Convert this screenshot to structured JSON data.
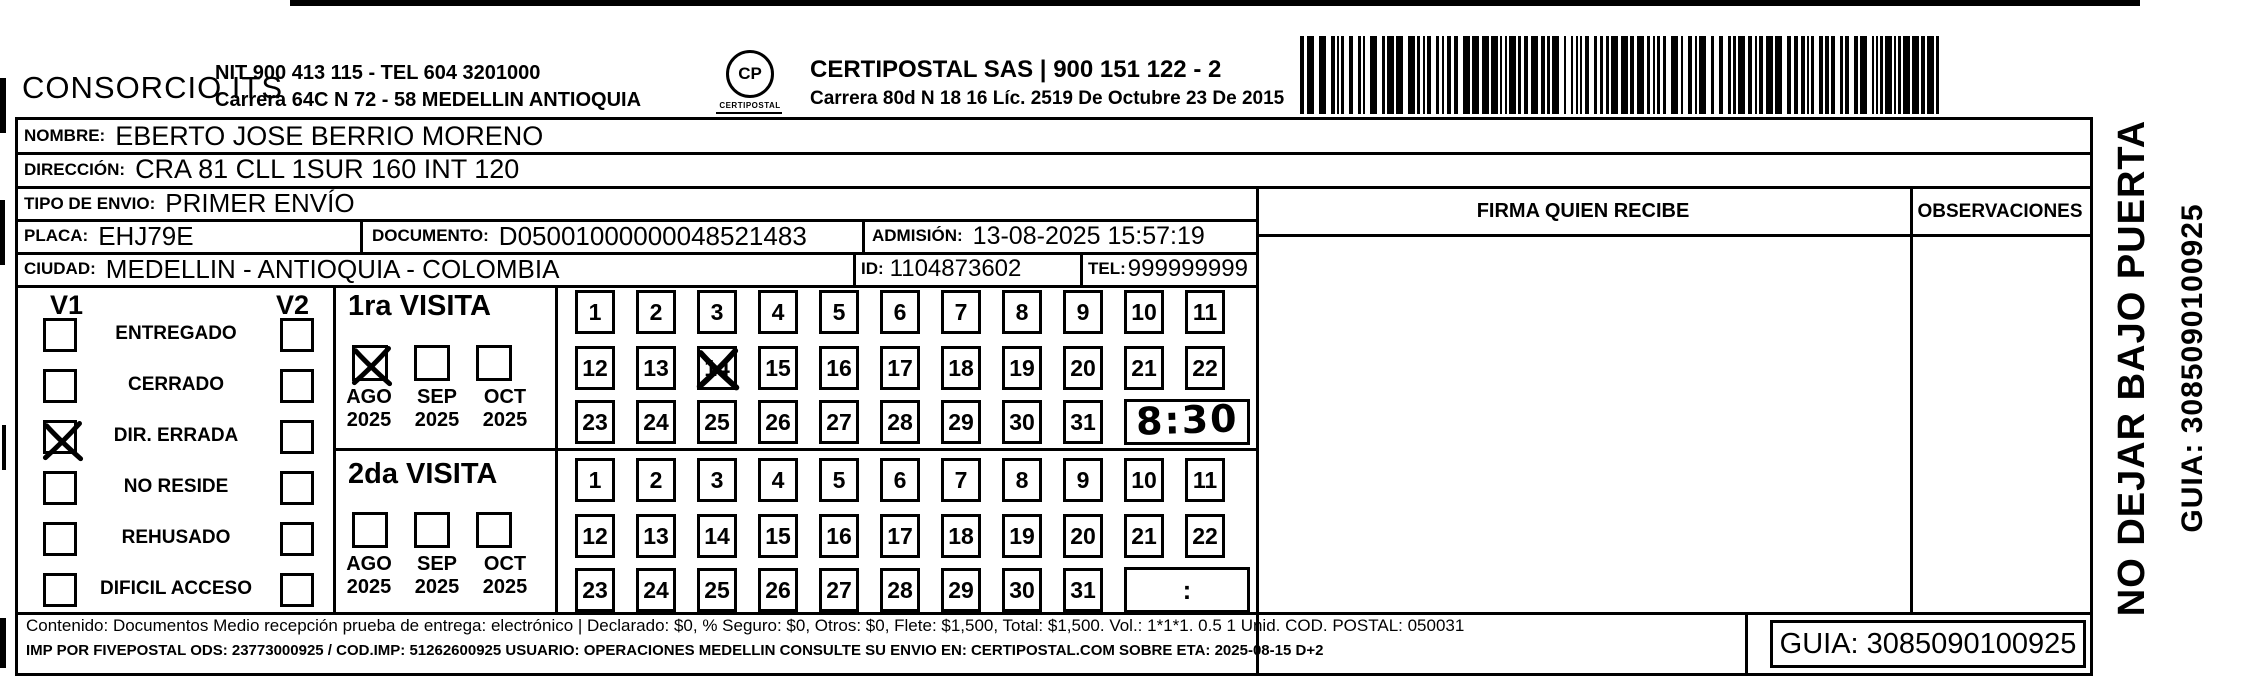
{
  "header": {
    "consorcio": "CONSORCIO ITS",
    "nit_line1": "NIT 900 413 115 - TEL 604 3201000",
    "nit_line2": "Carrera 64C N 72 - 58 MEDELLIN ANTIOQUIA",
    "logo_mark": "CP",
    "logo_text": "CERTIPOSTAL",
    "certipostal_line1": "CERTIPOSTAL SAS | 900 151 122 - 2",
    "certipostal_line2": "Carrera 80d N 18 16  Líc. 2519 De Octubre 23 De 2015"
  },
  "fields": {
    "nombre_label": "NOMBRE:",
    "nombre": "EBERTO JOSE BERRIO MORENO",
    "direccion_label": "DIRECCIÓN:",
    "direccion": "CRA 81 CLL 1SUR 160 INT 120",
    "tipo_envio_label": "TIPO DE ENVIO:",
    "tipo_envio": "PRIMER ENVÍO",
    "placa_label": "PLACA:",
    "placa": "EHJ79E",
    "documento_label": "DOCUMENTO:",
    "documento": "D05001000000048521483",
    "admision_label": "ADMISIÓN:",
    "admision": "13-08-2025 15:57:19",
    "ciudad_label": "CIUDAD:",
    "ciudad": "MEDELLIN - ANTIOQUIA - COLOMBIA",
    "id_label": "ID:",
    "id": "1104873602",
    "tel_label": "TEL:",
    "tel": "999999999"
  },
  "columns": {
    "firma_header": "FIRMA QUIEN RECIBE",
    "observaciones_header": "OBSERVACIONES"
  },
  "status": {
    "v1_label": "V1",
    "v2_label": "V2",
    "options": [
      {
        "label": "ENTREGADO",
        "v1_checked": false,
        "v2_checked": false
      },
      {
        "label": "CERRADO",
        "v1_checked": false,
        "v2_checked": false
      },
      {
        "label": "DIR. ERRADA",
        "v1_checked": true,
        "v2_checked": false
      },
      {
        "label": "NO RESIDE",
        "v1_checked": false,
        "v2_checked": false
      },
      {
        "label": "REHUSADO",
        "v1_checked": false,
        "v2_checked": false
      },
      {
        "label": "DIFICIL ACCESO",
        "v1_checked": false,
        "v2_checked": false
      }
    ]
  },
  "visits": [
    {
      "title": "1ra VISITA",
      "months": [
        {
          "label": "AGO",
          "year": "2025",
          "checked": true
        },
        {
          "label": "SEP",
          "year": "2025",
          "checked": false
        },
        {
          "label": "OCT",
          "year": "2025",
          "checked": false
        }
      ],
      "days_row1": [
        "1",
        "2",
        "3",
        "4",
        "5",
        "6",
        "7",
        "8",
        "9",
        "10",
        "11"
      ],
      "days_row2": [
        "12",
        "13",
        "14",
        "15",
        "16",
        "17",
        "18",
        "19",
        "20",
        "21",
        "22"
      ],
      "days_row3": [
        "23",
        "24",
        "25",
        "26",
        "27",
        "28",
        "29",
        "30",
        "31"
      ],
      "crossed_day": "14",
      "time": "8:30"
    },
    {
      "title": "2da VISITA",
      "months": [
        {
          "label": "AGO",
          "year": "2025",
          "checked": false
        },
        {
          "label": "SEP",
          "year": "2025",
          "checked": false
        },
        {
          "label": "OCT",
          "year": "2025",
          "checked": false
        }
      ],
      "days_row1": [
        "1",
        "2",
        "3",
        "4",
        "5",
        "6",
        "7",
        "8",
        "9",
        "10",
        "11"
      ],
      "days_row2": [
        "12",
        "13",
        "14",
        "15",
        "16",
        "17",
        "18",
        "19",
        "20",
        "21",
        "22"
      ],
      "days_row3": [
        "23",
        "24",
        "25",
        "26",
        "27",
        "28",
        "29",
        "30",
        "31"
      ],
      "crossed_day": null,
      "time": ":"
    }
  ],
  "footer": {
    "line1": "Contenido: Documentos Medio recepción prueba de entrega: electrónico | Declarado: $0, % Seguro: $0, Otros: $0, Flete: $1,500, Total: $1,500. Vol.: 1*1*1. 0.5  1 Unid. COD. POSTAL: 050031",
    "line2": "IMP POR FIVEPOSTAL ODS: 23773000925 / COD.IMP: 51262600925 USUARIO: OPERACIONES MEDELLIN CONSULTE SU ENVIO EN: CERTIPOSTAL.COM SOBRE ETA: 2025-08-15 D+2",
    "guia": "GUIA: 3085090100925"
  },
  "side": {
    "line1": "NO DEJAR BAJO PUERTA",
    "line2": "GUIA: 3085090100925"
  }
}
